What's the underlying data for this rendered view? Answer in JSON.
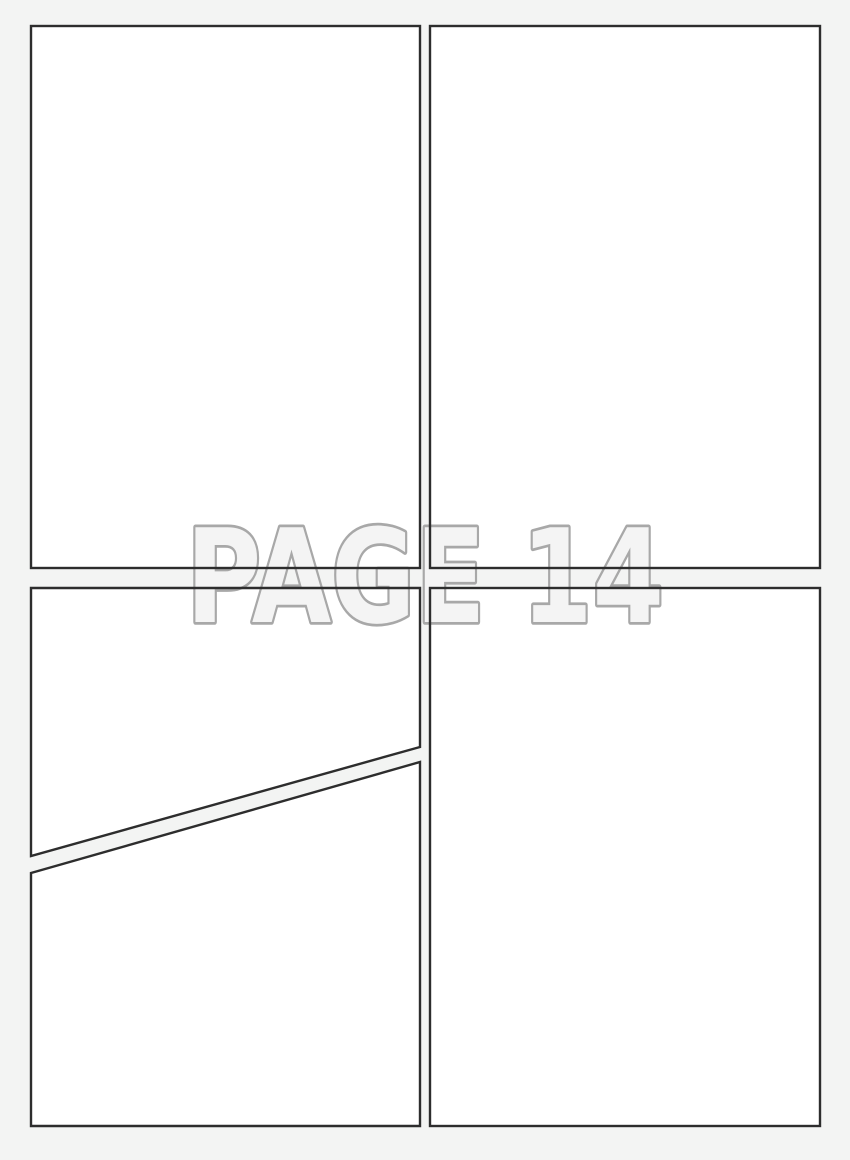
{
  "page": {
    "label": "PAGE 14"
  },
  "panels": {
    "top_left": "blank comic panel",
    "top_right": "blank comic panel",
    "bottom_left_upper": "blank comic panel (diagonal cut bottom edge)",
    "bottom_left_lower": "blank comic panel (diagonal cut top edge)",
    "bottom_right": "blank comic panel"
  },
  "colors": {
    "page_background": "#f3f4f3",
    "panel_fill": "#ffffff",
    "panel_border": "#2d2d2d",
    "page_label_fill": "#f4f4f4",
    "page_label_outline": "#a8a8a8"
  }
}
